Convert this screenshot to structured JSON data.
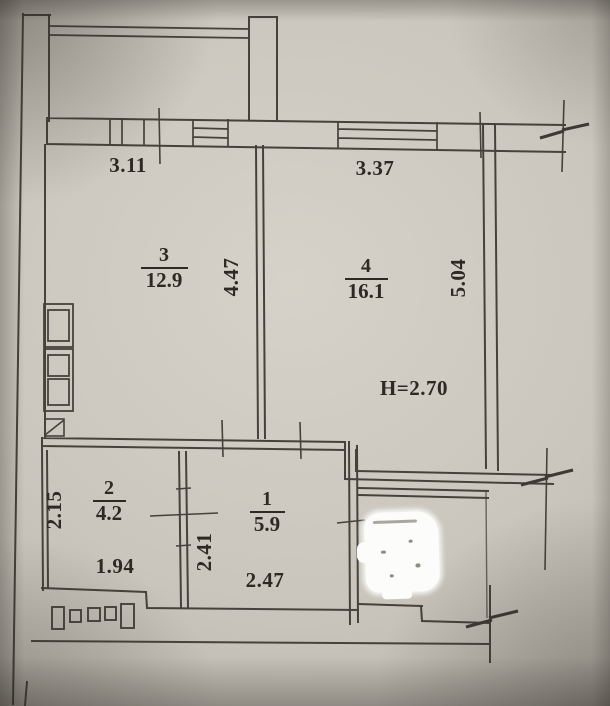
{
  "rooms": {
    "room1": {
      "number": "1",
      "area": "5.9"
    },
    "room2": {
      "number": "2",
      "area": "4.2"
    },
    "room3": {
      "number": "3",
      "area": "12.9"
    },
    "room4": {
      "number": "4",
      "area": "16.1"
    }
  },
  "dimensions": {
    "room3_width": "3.11",
    "room4_width": "3.37",
    "room3_depth": "4.47",
    "room4_depth": "5.04",
    "ceiling_height": "H=2.70",
    "room2_depth": "2.15",
    "room2_width": "1.94",
    "hallway_depth": "2.41",
    "hallway_width": "2.47"
  },
  "symbols": {
    "censored_area": "white-out-blob",
    "wall_break": "break-mark",
    "window": "double-line-window",
    "vent": "vent-shaft",
    "wardrobe": "storage-blocks",
    "balcony": "railing"
  },
  "colors": {
    "paper": "#c9c5bc",
    "ink": "#46423b",
    "text": "#2d2a24",
    "censor": "#fcfcfa"
  }
}
